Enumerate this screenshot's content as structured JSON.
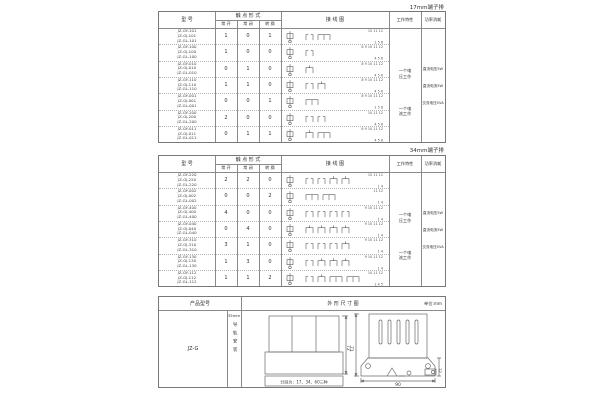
{
  "captions": {
    "table1": "17mm端子排",
    "table2": "34mm端子排"
  },
  "headers": {
    "model": "型  号",
    "contact_form": "触 点 形 式",
    "no": "常 开",
    "nc": "常 闭",
    "co": "转 换",
    "wiring": "接  线  图",
    "work": "工作特性",
    "power": "功率消耗"
  },
  "tables": [
    {
      "caption": "17mm端子排",
      "rows": [
        {
          "models": [
            "JZ-GY-101",
            "JZ-GJ-101",
            "JZ-GL-101"
          ],
          "no": "1",
          "nc": "0",
          "co": "1",
          "t_top": "10 11 12",
          "t_bot": "1  5  6"
        },
        {
          "models": [
            "JZ-GY-100",
            "JZ-GJ-100",
            "JZ-GL-100"
          ],
          "no": "1",
          "nc": "0",
          "co": "0",
          "t_top": "8 9 10 11 12",
          "t_bot": "4 5 6"
        },
        {
          "models": [
            "JZ-GY-010",
            "JZ-GJ-010",
            "JZ-GL-010"
          ],
          "no": "0",
          "nc": "1",
          "co": "0",
          "t_top": "8 9 10 11 12",
          "t_bot": "4 5 6"
        },
        {
          "models": [
            "JZ-GY-110",
            "JZ-GJ-110",
            "JZ-GL-110"
          ],
          "no": "1",
          "nc": "1",
          "co": "0",
          "t_top": "8 9 10 11 12",
          "t_bot": "4 5 6"
        },
        {
          "models": [
            "JZ-GY-001",
            "JZ-GJ-001",
            "JZ-GL-001"
          ],
          "no": "0",
          "nc": "0",
          "co": "1",
          "t_top": "8 9 10 11 12",
          "t_bot": "1  5  6"
        },
        {
          "models": [
            "JZ-GY-200",
            "JZ-GJ-200",
            "JZ-GL-200"
          ],
          "no": "2",
          "nc": "0",
          "co": "0",
          "t_top": "10 11 12",
          "t_bot": "4 5 6"
        },
        {
          "models": [
            "JZ-GY-011",
            "JZ-GJ-011",
            "JZ-GL-011"
          ],
          "no": "0",
          "nc": "1",
          "co": "1",
          "t_top": "8 9 10 11 12",
          "t_bot": "4 5 6"
        }
      ],
      "work_notes": [
        "一个电压工作",
        "一个电流工作"
      ],
      "power_notes": [
        "直流电压5W",
        "直流电流5W",
        "交流电压5VA"
      ]
    },
    {
      "caption": "34mm端子排",
      "rows": [
        {
          "models": [
            "JZ-GY-220",
            "JZ-GJ-220",
            "JZ-GL-220"
          ],
          "no": "2",
          "nc": "2",
          "co": "0",
          "t_top": "10 11 12",
          "t_bot": "1  4"
        },
        {
          "models": [
            "JZ-GY-002",
            "JZ-GJ-002",
            "JZ-GL-002"
          ],
          "no": "0",
          "nc": "0",
          "co": "2",
          "t_top": "11 12",
          "t_bot": "1  4"
        },
        {
          "models": [
            "JZ-GY-400",
            "JZ-GJ-400",
            "JZ-GL-400"
          ],
          "no": "4",
          "nc": "0",
          "co": "0",
          "t_top": "9 10 11 12",
          "t_bot": "1  4"
        },
        {
          "models": [
            "JZ-GY-040",
            "JZ-GJ-040",
            "JZ-GL-040"
          ],
          "no": "0",
          "nc": "4",
          "co": "0",
          "t_top": "9 10 11 12",
          "t_bot": "1  4"
        },
        {
          "models": [
            "JZ-GY-310",
            "JZ-GJ-310",
            "JZ-GL-310"
          ],
          "no": "3",
          "nc": "1",
          "co": "0",
          "t_top": "9 10 11 12",
          "t_bot": "1  4"
        },
        {
          "models": [
            "JZ-GY-130",
            "JZ-GJ-130",
            "JZ-GL-130"
          ],
          "no": "1",
          "nc": "3",
          "co": "0",
          "t_top": "9 10 11 12",
          "t_bot": "1  4"
        },
        {
          "models": [
            "JZ-GY-112",
            "JZ-GJ-112",
            "JZ-GL-112"
          ],
          "no": "1",
          "nc": "1",
          "co": "2",
          "t_top": "10 11 12",
          "t_bot": "1  4  5"
        }
      ],
      "work_notes": [
        "一个电压工作",
        "一个电流工作"
      ],
      "power_notes": [
        "直流电压5W",
        "直流电流5W",
        "交流电压5VA"
      ]
    }
  ],
  "dimensions": {
    "header_model": "产品型号",
    "header_drawing": "外 形 尺 寸 图",
    "unit": "单位:mm",
    "model": "JZ-G",
    "rail_size": "35mm",
    "rail_text": "导轨安装",
    "front_height": "72",
    "front_note": "分别为：17、34、60三种",
    "side_height": "71",
    "side_width": "90",
    "side_depth": "12"
  }
}
